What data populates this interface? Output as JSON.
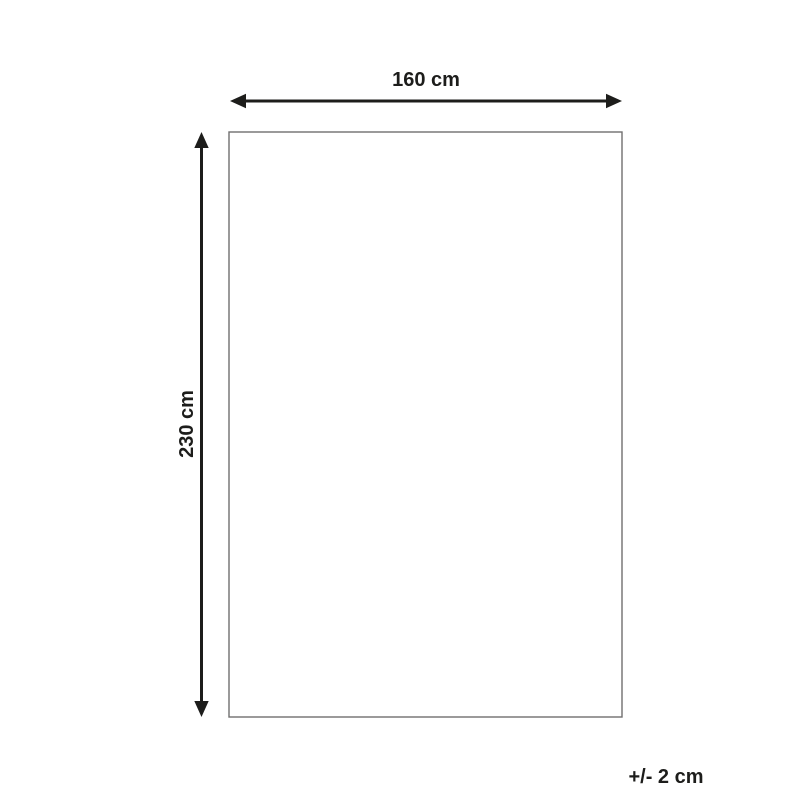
{
  "diagram": {
    "type": "product-dimension-diagram",
    "width_label": "160 cm",
    "height_label": "230 cm",
    "tolerance_label": "+/- 2 cm"
  },
  "colors": {
    "arrow-color": "#1d1d1b",
    "outline-color": "#706f6f",
    "background": "#ffffff",
    "text-color": "#1d1d1b"
  }
}
